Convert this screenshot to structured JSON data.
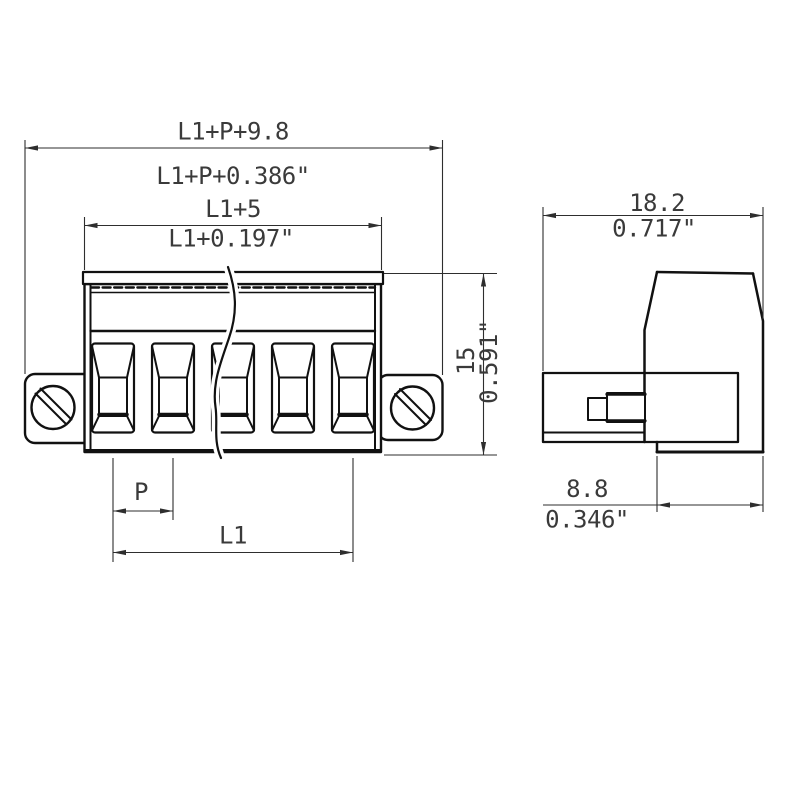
{
  "drawing": {
    "background_color": "#ffffff",
    "line_color": "#111111",
    "dimension_color": "#2e2e2e",
    "front_view": {
      "dim_overall_mm": "L1+P+9.8",
      "dim_overall_inch": "L1+P+0.386\"",
      "dim_inner_mm": "L1+5",
      "dim_inner_inch": "L1+0.197\"",
      "dim_height_mm": "15",
      "dim_height_inch": "0.591\"",
      "dim_pitch_label": "P",
      "dim_length_label": "L1",
      "pole_count": "5"
    },
    "side_view": {
      "dim_width_mm": "18.2",
      "dim_width_inch": "0.717\"",
      "dim_depth_mm": "8.8",
      "dim_depth_inch": "0.346\""
    }
  }
}
